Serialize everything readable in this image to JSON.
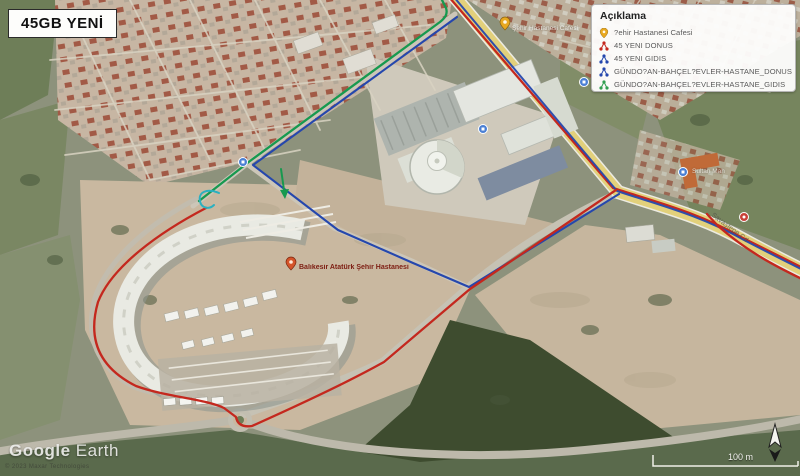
{
  "title_box": {
    "label": "45GB YENİ"
  },
  "legend": {
    "title": "Açıklama",
    "items": [
      {
        "icon": "place-pin-icon",
        "color": "#e8a820",
        "label": "?ehir Hastanesi Cafesi"
      },
      {
        "icon": "route-icon",
        "color": "#c4281e",
        "label": "45 YENI DONUS"
      },
      {
        "icon": "route-icon",
        "color": "#2547ad",
        "label": "45 YENI GIDIS"
      },
      {
        "icon": "route-icon",
        "color": "#2547ad",
        "label": "GÜNDO?AN-BAHÇEL?EVLER-HASTANE_DONUS"
      },
      {
        "icon": "route-icon",
        "color": "#2f9e4f",
        "label": "GÜNDO?AN-BAHÇEL?EVLER-HASTANE_GIDIS"
      }
    ]
  },
  "map_labels": {
    "hospital": "Balıkesir Atatürk Şehir Hastanesi",
    "cafe": "Şehir Hastanesi Cafesi",
    "district": "Sultan Mah",
    "street": "Mesut Akbay Cd",
    "road": "Savaştepe Cd"
  },
  "watermark": {
    "brand_a": "Google",
    "brand_b": "Earth",
    "copyright": "© 2023 Maxar Technologies"
  },
  "scale": {
    "label": "100 m"
  },
  "colors": {
    "route_red": "#c4281e",
    "route_blue": "#2547ad",
    "route_green": "#17994f",
    "route_teal": "#2ab0c0",
    "pin_yellow": "#e8a820",
    "road_yellow": "#e2d07b"
  }
}
